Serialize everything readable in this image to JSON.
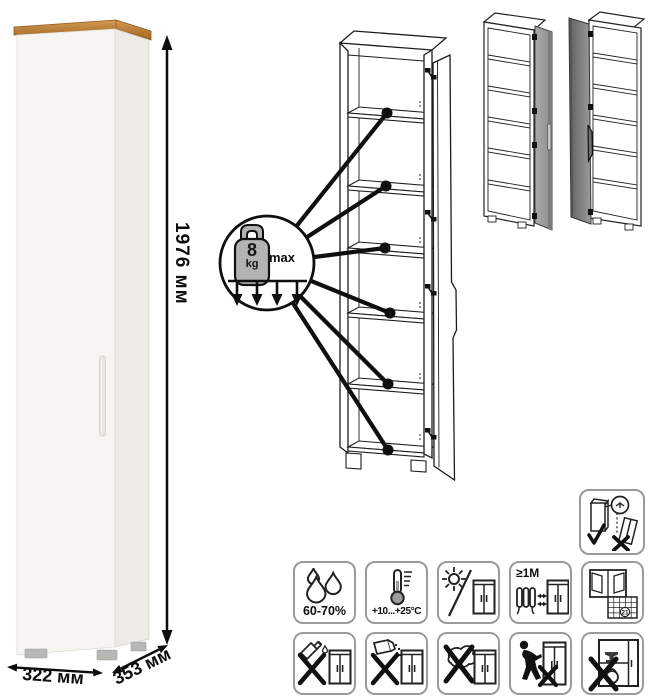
{
  "product": {
    "dimensions": {
      "height": "1976 мм",
      "width": "322 мм",
      "depth": "353 мм"
    },
    "shelf_load": {
      "value": "8",
      "unit": "kg",
      "qualifier": "max"
    }
  },
  "door_options": {
    "option_right_door": "door-hinged-on-right",
    "option_left_door": "door-hinged-on-left"
  },
  "care": {
    "humidity": {
      "icon": "water-drops-icon",
      "label": "60-70%"
    },
    "temperature": {
      "icon": "thermometer-icon",
      "label": "+10...+25°C"
    },
    "sunlight": {
      "icon": "no-direct-sunlight-icon"
    },
    "heat_distance": {
      "icon": "keep-distance-from-heat-icon",
      "label": "≥1М"
    },
    "ventilation": {
      "icon": "window-calendar-ventilation-icon",
      "calendar_day": "21"
    },
    "no_liquids": {
      "icon": "no-spilled-liquids-icon"
    },
    "no_powders": {
      "icon": "no-abrasive-powder-icon"
    },
    "no_scouring": {
      "icon": "no-scouring-pad-icon"
    },
    "no_dragging": {
      "icon": "do-not-drag-icon"
    },
    "no_overload": {
      "icon": "do-not-overload-icon"
    },
    "wall_anchor": {
      "icon": "anchor-to-wall-icon"
    }
  },
  "colors": {
    "wood_top": "#c08a3e",
    "cabinet_front": "#f6f5f1",
    "cabinet_side": "#edebe5",
    "variant_door_gray": "#9b9b9b",
    "outline": "#1c1c1c",
    "cell_border": "#9b9b9b",
    "metal_gray": "#b3b3b3"
  }
}
